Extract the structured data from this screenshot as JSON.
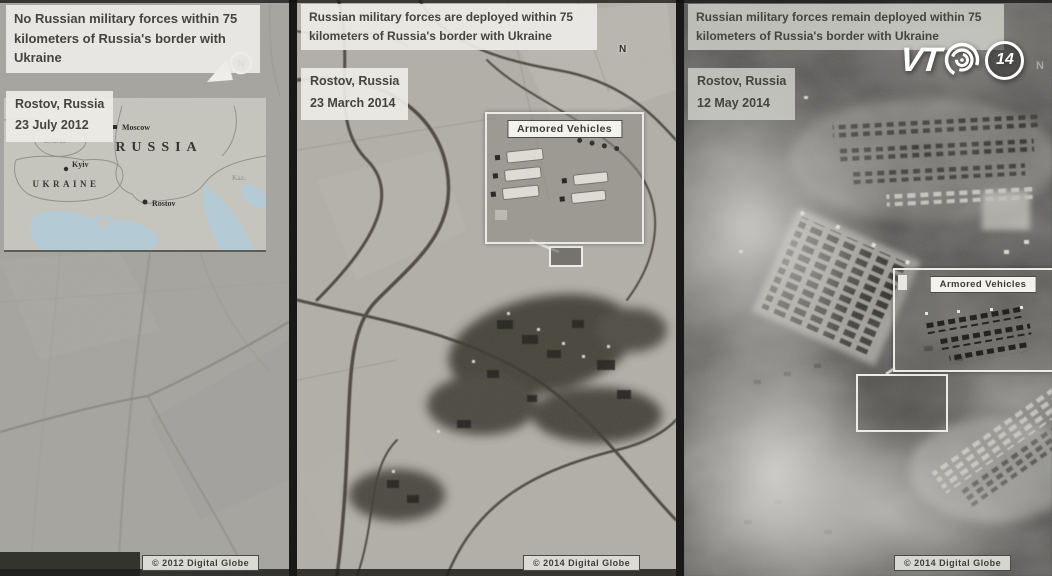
{
  "colors": {
    "map_water": "#b4cbd5",
    "annotation_white": "#ecebe5"
  },
  "logo": {
    "vt": "VT",
    "number": "14"
  },
  "panels": [
    {
      "title": "No Russian military forces within 75 kilometers of Russia's border with Ukraine",
      "location": "Rostov, Russia",
      "date": "23 July 2012",
      "copyright": "© 2012 Digital Globe",
      "north": "N",
      "map": {
        "russia": "RUSSIA",
        "ukraine": "UKRAINE",
        "belarus": "Belarus",
        "kazakhstan": "Kaz.",
        "moscow": "Moscow",
        "kyiv": "Kyiv",
        "rostov": "Rostov"
      }
    },
    {
      "title": "Russian military forces are deployed within 75 kilometers of Russia's border with Ukraine",
      "location": "Rostov, Russia",
      "date": "23 March 2014",
      "copyright": "© 2014 Digital Globe",
      "north": "N",
      "annotation": "Armored Vehicles"
    },
    {
      "title": "Russian military forces remain deployed within 75 kilometers of Russia's border with Ukraine",
      "location": "Rostov, Russia",
      "date": "12 May 2014",
      "copyright": "© 2014 Digital Globe",
      "north": "N",
      "annotation": "Armored Vehicles"
    }
  ]
}
